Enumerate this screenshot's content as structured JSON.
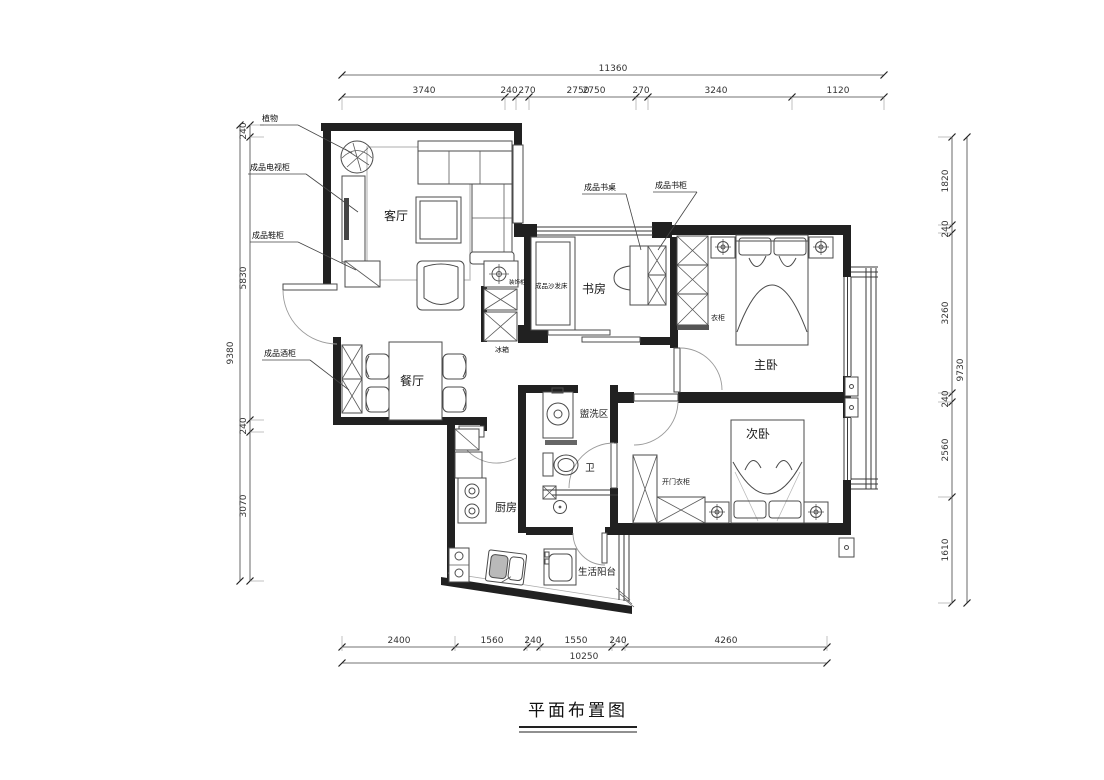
{
  "title": "平面布置图",
  "colors": {
    "wall": "#212121",
    "line": "#333333",
    "furniture": "#4b4b4b"
  },
  "rooms": {
    "living": "客厅",
    "dining": "餐厅",
    "study": "书房",
    "master": "主卧",
    "second": "次卧",
    "wash": "盥洗区",
    "wc": "卫",
    "kitchen": "厨房",
    "balcony": "生活阳台"
  },
  "callouts": {
    "plant": "植物",
    "tv": "成品电视柜",
    "shoe": "成品鞋柜",
    "wine": "成品酒柜",
    "desk": "成品书桌",
    "bookcase": "成品书柜",
    "sofabed": "成品沙发床",
    "deco": "装饰柜",
    "fridge": "冰箱",
    "wardrobe": "衣柜",
    "door_wardrobe": "开门衣柜"
  },
  "dims": {
    "top": {
      "total": "11360",
      "segs": [
        "3740",
        "240",
        "270",
        "2750",
        "2750",
        "270",
        "3240",
        "1120"
      ]
    },
    "bottom": {
      "total": "10250",
      "segs": [
        "2400",
        "1560",
        "240",
        "1550",
        "240",
        "4260"
      ]
    },
    "left": {
      "total": "9380",
      "segs": [
        "240",
        "5830",
        "240",
        "3070"
      ]
    },
    "right": {
      "total": "9730",
      "segs": [
        "1820",
        "240",
        "3260",
        "240",
        "2560",
        "1610"
      ]
    }
  }
}
